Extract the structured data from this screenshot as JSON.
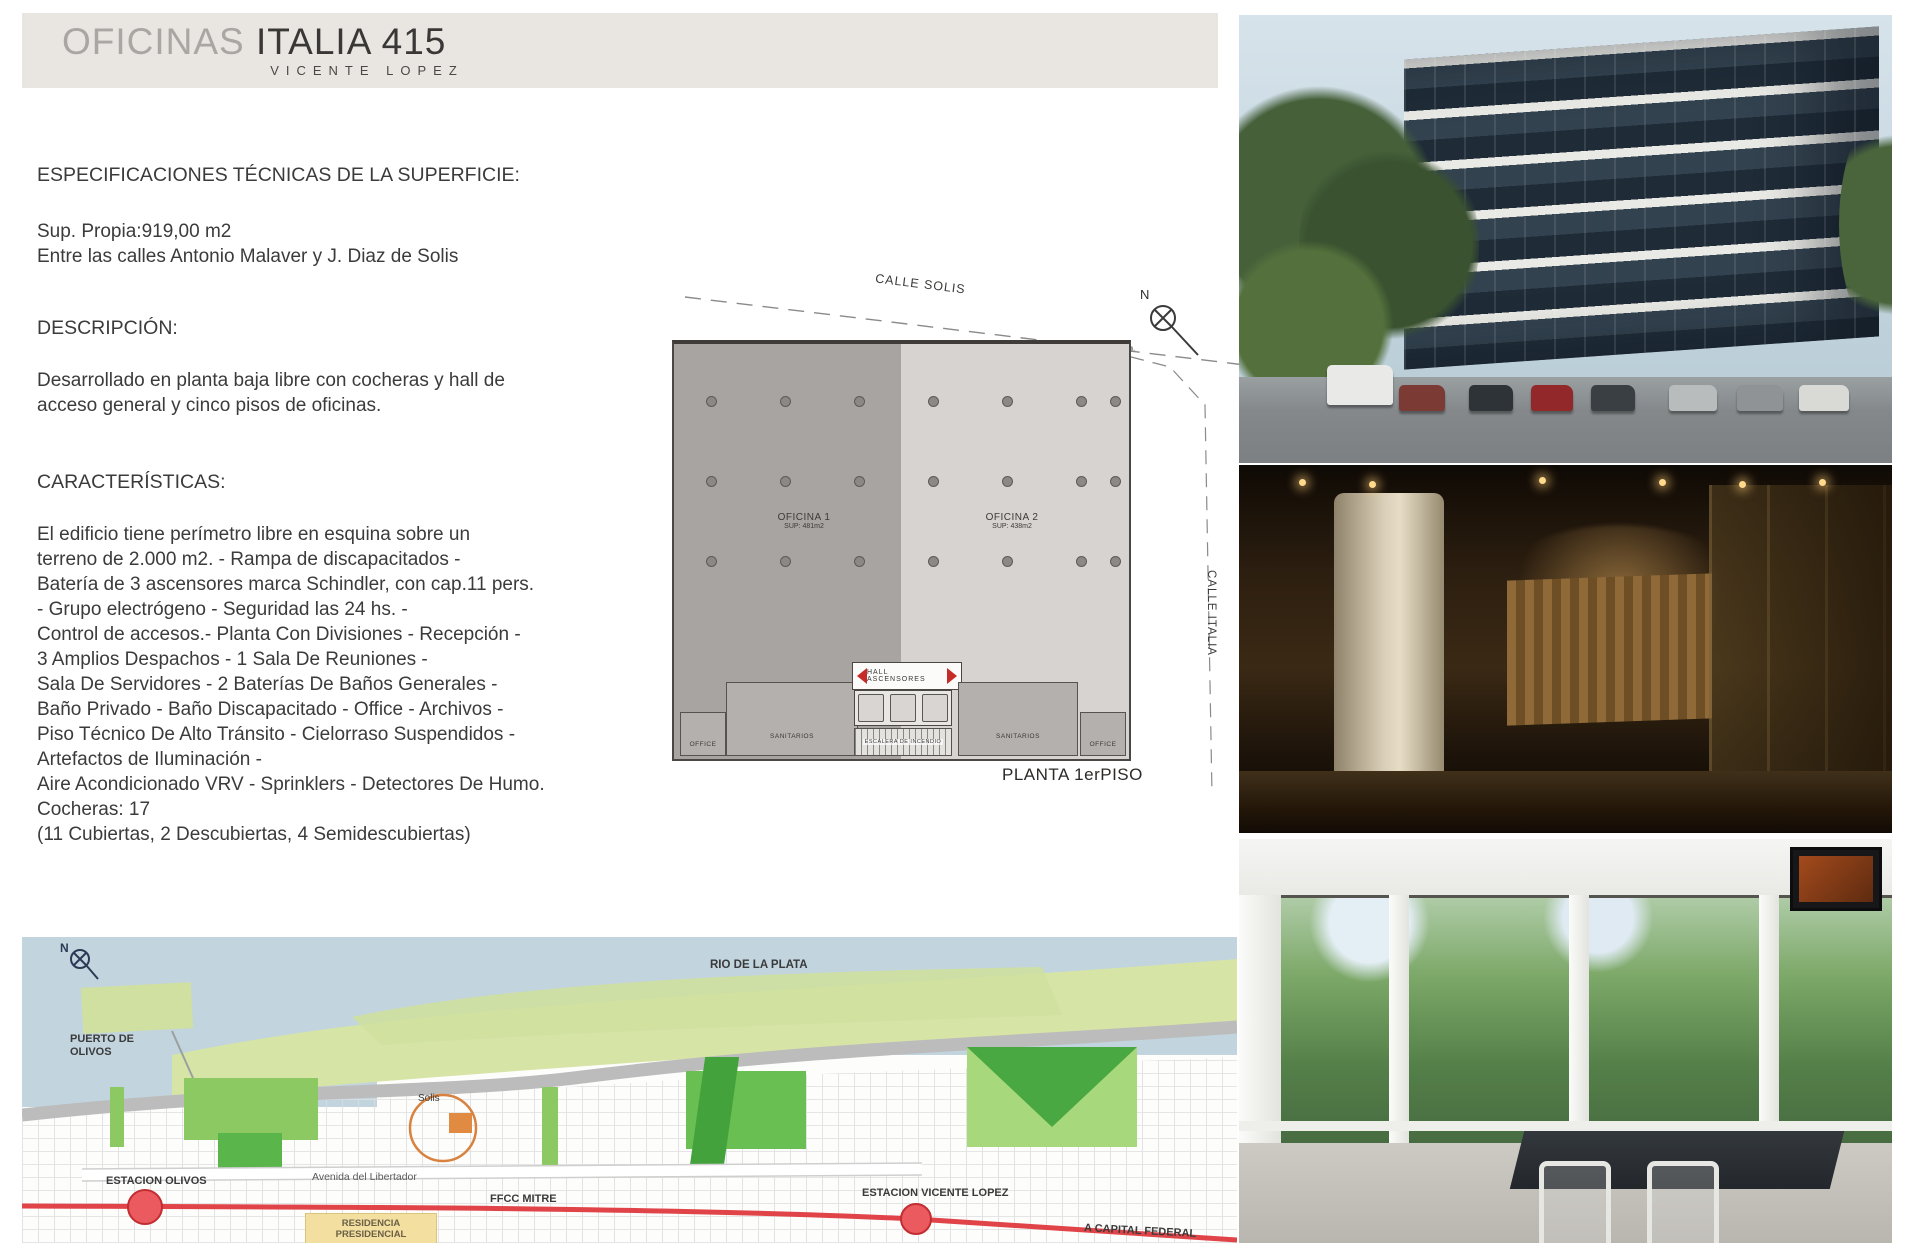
{
  "header": {
    "brand_light": "OFICINAS",
    "brand_dark": "ITALIA 415",
    "subtitle": "VICENTE LOPEZ"
  },
  "specs": {
    "title": "ESPECIFICACIONES TÉCNICAS DE LA SUPERFICIE:",
    "lines": [
      "Sup. Propia:919,00 m2",
      "Entre las calles Antonio Malaver y J. Diaz de Solis"
    ]
  },
  "description": {
    "title": "DESCRIPCIÓN:",
    "lines": [
      "Desarrollado en planta baja libre con cocheras y hall de",
      "acceso general y cinco pisos de oficinas."
    ]
  },
  "features": {
    "title": "CARACTERÍSTICAS:",
    "lines": [
      "El edificio tiene perímetro libre en esquina sobre un",
      "terreno de 2.000 m2. - Rampa de discapacitados -",
      "Batería de 3 ascensores marca Schindler, con cap.11 pers.",
      "- Grupo electrógeno - Seguridad las 24 hs. -",
      "Control de accesos.- Planta Con Divisiones - Recepción -",
      "3 Amplios Despachos - 1 Sala De Reuniones -",
      "Sala De Servidores - 2 Baterías De Baños Generales -",
      "Baño Privado - Baño Discapacitado - Office - Archivos -",
      "Piso Técnico De Alto Tránsito - Cielorraso Suspendidos -",
      "Artefactos de Iluminación -",
      "Aire Acondicionado VRV - Sprinklers - Detectores De Humo.",
      "Cocheras: 17",
      "(11 Cubiertas, 2 Descubiertas, 4 Semidescubiertas)"
    ]
  },
  "floorplan": {
    "street_top": "CALLE SOLIS",
    "street_right": "CALLE ITALIA",
    "north_label": "N",
    "lm_label": "L.M.",
    "office1_name": "OFICINA 1",
    "office1_sup": "SUP: 481m2",
    "office2_name": "OFICINA 2",
    "office2_sup": "SUP: 438m2",
    "hall_label": "HALL ASCENSORES",
    "stairs_label": "ESCALERA DE INCENDIO",
    "sanitarios_left": "SANITARIOS",
    "sanitarios_right": "SANITARIOS",
    "office_room_left": "OFFICE",
    "office_room_right": "OFFICE",
    "caption": "PLANTA 1erPISO"
  },
  "map": {
    "north_label": "N",
    "river": "RIO DE LA PLATA",
    "port_line1": "PUERTO DE",
    "port_line2": "OLIVOS",
    "station_olivos": "ESTACION OLIVOS",
    "avenue": "Avenida del Libertador",
    "site_marker": "Solis",
    "rail": "FFCC MITRE",
    "station_vicente_lopez": "ESTACION VICENTE LOPEZ",
    "to_capital": "A CAPITAL FEDERAL",
    "residence_line1": "RESIDENCIA",
    "residence_line2": "PRESIDENCIAL"
  },
  "photos": {
    "photo1_alt": "building-exterior",
    "photo2_alt": "lobby-interior",
    "photo3_alt": "office-interior"
  },
  "colors": {
    "header_bg": "#e9e6e1",
    "brand_gray": "#a9a6a3",
    "text": "#3b3b3b",
    "plan_office1_fill": "#a8a4a1",
    "plan_office2_fill": "#d6d3d0",
    "hall_arrow_red": "#c52b27",
    "map_water": "#c2d4de",
    "map_park_green": "#6abf52",
    "map_rail_red": "#e04448",
    "map_site_orange": "#d9823f",
    "map_residence_yellow": "#f3dfa0"
  }
}
